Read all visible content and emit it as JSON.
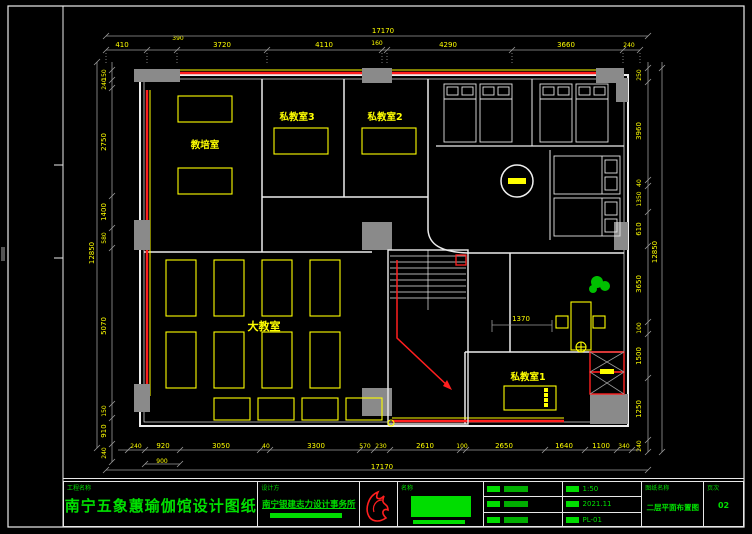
{
  "labels": {
    "room_training": "教培室",
    "room_private3": "私教室3",
    "room_private2": "私教室2",
    "room_big": "大教室",
    "room_private1": "私教室1"
  },
  "dims": {
    "top_total": "17170",
    "top": [
      "410",
      "390",
      "3720",
      "4110",
      "160",
      "4290",
      "3660",
      "240"
    ],
    "bottom_total": "17170",
    "bottom": [
      "240",
      "920",
      "3050",
      "40",
      "3300",
      "570",
      "230",
      "2610",
      "100",
      "2650",
      "1640",
      "1100",
      "340"
    ],
    "bottom_sub": "900",
    "left_total": "12850",
    "left": [
      "150",
      "240",
      "2750",
      "1400",
      "580",
      "5070",
      "150",
      "910",
      "240"
    ],
    "right_total": "12850",
    "right": [
      "250",
      "3960",
      "40",
      "1350",
      "610",
      "3650",
      "100",
      "1500",
      "1250",
      "240"
    ],
    "desk": "1370"
  },
  "title_block": {
    "project_label": "工程名称",
    "project_name": "南宁五象蕙瑜伽馆设计图纸",
    "designer_label": "设计方",
    "designer_name": "南宁银建志力设计事务所",
    "name_label": "名称",
    "scale_value": "1:50",
    "date_value": "2021.11",
    "no_value": "PL-01",
    "drawing_label": "图纸名称",
    "drawing_name": "二层平面布置图",
    "page_label": "页次",
    "page_value": "02"
  },
  "colors": {
    "dim_text": "#ffff00",
    "wall": "#ececec",
    "accent_red": "#ff1f1f",
    "title_green": "#00e000",
    "column_gray": "#8a8a8a"
  }
}
